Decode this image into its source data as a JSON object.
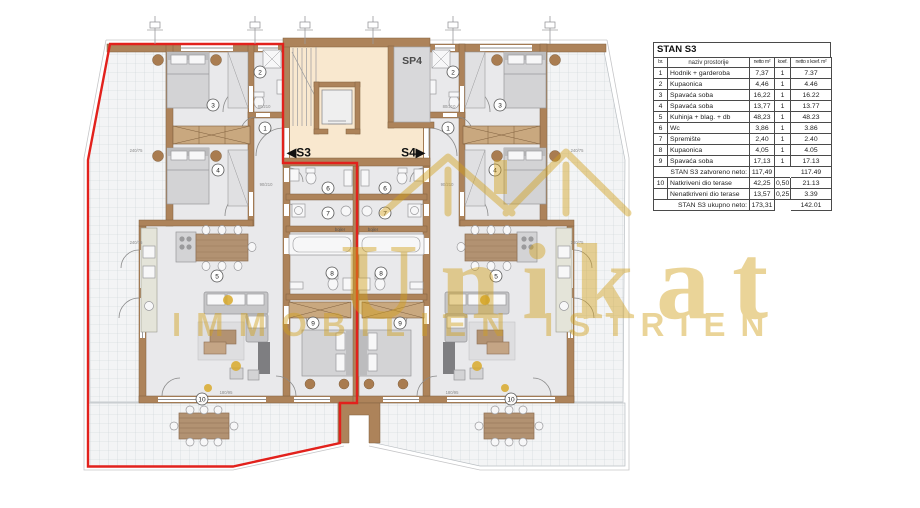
{
  "watermark": {
    "brand": "Unikat",
    "subtitle": "IMMOBILIEN ISTRIEN",
    "color": "#d2a11d"
  },
  "plan": {
    "sp4_label": "SP4",
    "s3_label": "◀S3",
    "s4_label": "S4▶",
    "bojler_label": "bojler",
    "outline_color": "#e2211c",
    "markers_s3": [
      {
        "n": "1",
        "x": 265,
        "y": 128
      },
      {
        "n": "2",
        "x": 260,
        "y": 72
      },
      {
        "n": "3",
        "x": 213,
        "y": 105
      },
      {
        "n": "4",
        "x": 218,
        "y": 170
      },
      {
        "n": "5",
        "x": 217,
        "y": 276
      },
      {
        "n": "6",
        "x": 328,
        "y": 188
      },
      {
        "n": "7",
        "x": 328,
        "y": 213
      },
      {
        "n": "8",
        "x": 332,
        "y": 273
      },
      {
        "n": "9",
        "x": 313,
        "y": 323
      },
      {
        "n": "10",
        "x": 202,
        "y": 399
      }
    ],
    "markers_s4": [
      {
        "n": "1",
        "x": 448,
        "y": 128
      },
      {
        "n": "2",
        "x": 453,
        "y": 72
      },
      {
        "n": "3",
        "x": 500,
        "y": 105
      },
      {
        "n": "4",
        "x": 495,
        "y": 170
      },
      {
        "n": "5",
        "x": 496,
        "y": 276
      },
      {
        "n": "6",
        "x": 385,
        "y": 188
      },
      {
        "n": "7",
        "x": 385,
        "y": 213
      },
      {
        "n": "8",
        "x": 381,
        "y": 273
      },
      {
        "n": "9",
        "x": 400,
        "y": 323
      },
      {
        "n": "10",
        "x": 511,
        "y": 399
      }
    ],
    "dim_labels": [
      {
        "t": "240/75",
        "x": 136,
        "y": 152
      },
      {
        "t": "240/75",
        "x": 136,
        "y": 244
      },
      {
        "t": "80/210",
        "x": 264,
        "y": 108
      },
      {
        "t": "90/210",
        "x": 266,
        "y": 186
      },
      {
        "t": "180/95",
        "x": 226,
        "y": 394
      },
      {
        "t": "180/95",
        "x": 452,
        "y": 394
      },
      {
        "t": "90/210",
        "x": 447,
        "y": 186
      },
      {
        "t": "80/210",
        "x": 449,
        "y": 108
      },
      {
        "t": "240/75",
        "x": 577,
        "y": 152
      },
      {
        "t": "240/75",
        "x": 577,
        "y": 244
      }
    ],
    "survey_marker_xs": [
      155,
      255,
      305,
      373,
      453,
      550
    ]
  },
  "table": {
    "title": "STAN S3",
    "columns": [
      "br.",
      "naziv prostorije",
      "netto m²",
      "koef.",
      "netto x koef. m²"
    ],
    "rows": [
      {
        "br": "1",
        "name": "Hodnik + garderoba",
        "netto": "7,37",
        "koef": "1",
        "total": "7.37"
      },
      {
        "br": "2",
        "name": "Kupaonica",
        "netto": "4,46",
        "koef": "1",
        "total": "4.46"
      },
      {
        "br": "3",
        "name": "Spavaća soba",
        "netto": "16,22",
        "koef": "1",
        "total": "16.22"
      },
      {
        "br": "4",
        "name": "Spavaća soba",
        "netto": "13,77",
        "koef": "1",
        "total": "13.77"
      },
      {
        "br": "5",
        "name": "Kuhinja + blag. + db",
        "netto": "48,23",
        "koef": "1",
        "total": "48.23"
      },
      {
        "br": "6",
        "name": "Wc",
        "netto": "3,86",
        "koef": "1",
        "total": "3.86"
      },
      {
        "br": "7",
        "name": "Spremište",
        "netto": "2,40",
        "koef": "1",
        "total": "2.40"
      },
      {
        "br": "8",
        "name": "Kupaonica",
        "netto": "4,05",
        "koef": "1",
        "total": "4.05"
      },
      {
        "br": "9",
        "name": "Spavaća soba",
        "netto": "17,13",
        "koef": "1",
        "total": "17.13"
      },
      {
        "type": "subtotal",
        "name": "STAN S3 zatvoreno neto:",
        "netto": "117,49",
        "total": "117.49"
      },
      {
        "br": "10",
        "name": "Natkriveni dio terase",
        "netto": "42,25",
        "koef": "0,50",
        "total": "21.13"
      },
      {
        "br": "",
        "name": "Nenatkriveni dio terase",
        "netto": "13,57",
        "koef": "0,25",
        "total": "3.39"
      },
      {
        "type": "subtotal",
        "name": "STAN S3 ukupno neto:",
        "netto": "173,31",
        "total": "142.01"
      }
    ]
  },
  "colors": {
    "outline_red": "#e2211c",
    "stairwell_beige": "#f9e8cf",
    "wall_brown": "#ad835a",
    "watermark_gold": "#d2a11d"
  }
}
